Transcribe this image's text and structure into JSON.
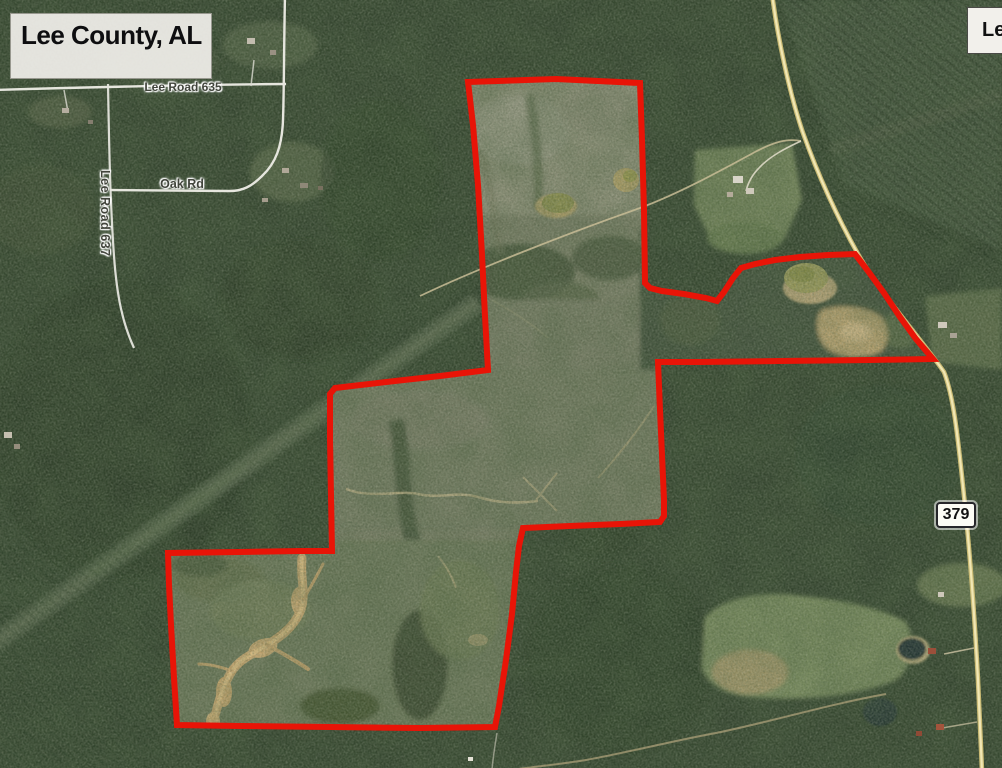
{
  "map": {
    "county_label": "Lee County, AL",
    "legend_label": "Legend",
    "roads": {
      "lee_road_635": "Lee Road 635",
      "oak_rd": "Oak Rd",
      "lee_road_637": "Lee Road 637"
    },
    "route_shield": "379",
    "colors": {
      "boundary": "#e81407",
      "highway": "#f1e7b4",
      "road": "#e6e6de",
      "forest": "#33432e",
      "sand": "#c9a76f"
    }
  }
}
